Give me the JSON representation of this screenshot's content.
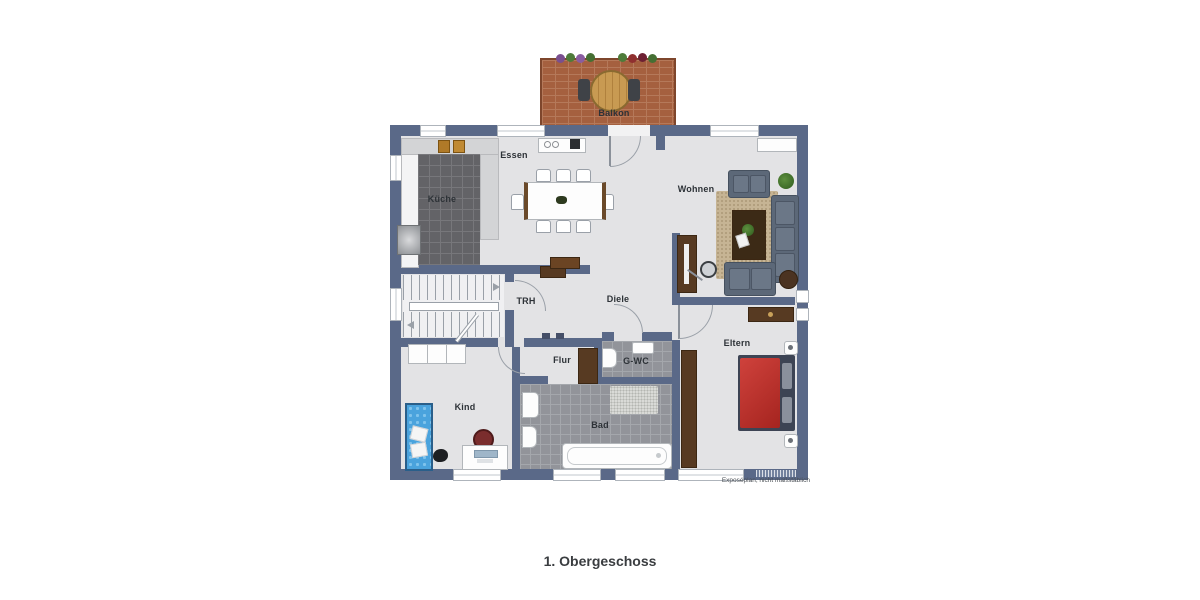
{
  "plan": {
    "title": "1. Obergeschoss",
    "caption": "Exposéplan, nicht maßstäblich",
    "rooms": {
      "balkon": {
        "label": "Balkon"
      },
      "essen": {
        "label": "Essen"
      },
      "kueche": {
        "label": "Küche"
      },
      "wohnen": {
        "label": "Wohnen"
      },
      "trh": {
        "label": "TRH"
      },
      "diele": {
        "label": "Diele"
      },
      "flur": {
        "label": "Flur"
      },
      "gwc": {
        "label": "G-WC"
      },
      "kind": {
        "label": "Kind"
      },
      "bad": {
        "label": "Bad"
      },
      "eltern": {
        "label": "Eltern"
      }
    },
    "colors": {
      "wall": "#5a6988",
      "floor": "#e3e3e5",
      "kitchen_tile": "#636367",
      "bath_tile": "#92949a",
      "balcony_brick": "#a5603f",
      "rug": "#c6b494",
      "sofa": "#5c6878",
      "bed_parents": "#c2332e",
      "bed_child": "#4aa3dd",
      "wood_furniture": "#573a22"
    }
  }
}
